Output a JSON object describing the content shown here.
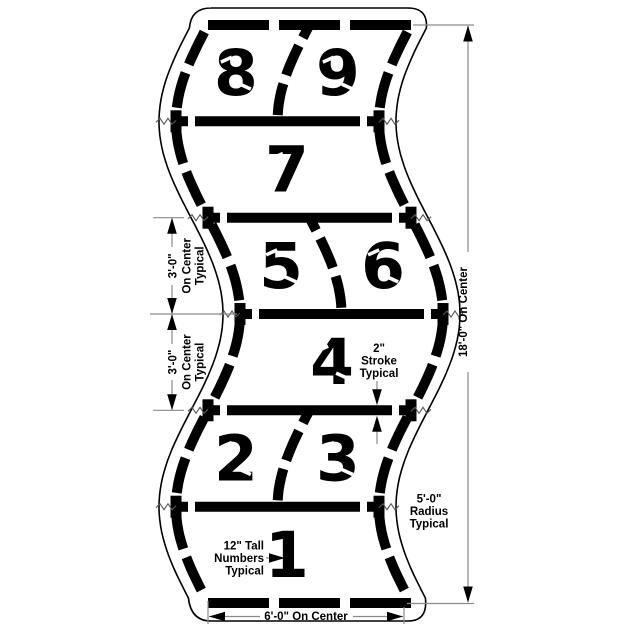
{
  "diagram": {
    "kind": "hopscotch-court-stencil-detail",
    "colors": {
      "ink": "#000000",
      "thin_line": "#8a8a8a",
      "background": "#ffffff"
    },
    "cells": [
      {
        "band": 1,
        "numbers": [
          "8",
          "9"
        ]
      },
      {
        "band": 2,
        "numbers": [
          "7"
        ]
      },
      {
        "band": 3,
        "numbers": [
          "5",
          "6"
        ]
      },
      {
        "band": 4,
        "numbers": [
          "4"
        ]
      },
      {
        "band": 5,
        "numbers": [
          "2",
          "3"
        ]
      },
      {
        "band": 6,
        "numbers": [
          "1"
        ]
      }
    ],
    "dimensions": {
      "left_upper": [
        "3'-0\"",
        "On Center",
        "Typical"
      ],
      "left_lower": [
        "3'-0\"",
        "On Center",
        "Typical"
      ],
      "right": "18'-0\"  On  Center",
      "bottom": "6'-0\"  On  Center",
      "stroke_note": [
        "2\"",
        "Stroke",
        "Typical"
      ],
      "radius_note": [
        "5'-0\"",
        "Radius",
        "Typical"
      ],
      "numbers_note": [
        "12\"  Tall",
        "Numbers",
        "Typical"
      ]
    }
  }
}
